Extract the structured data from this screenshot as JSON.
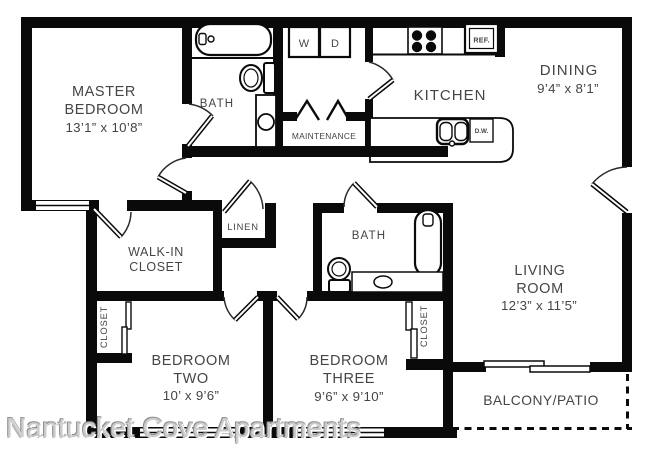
{
  "watermark": "Nantucket Cove Apartments",
  "colors": {
    "wall": "#0a0a0a",
    "label": "#454545",
    "watermark": "#cccccc",
    "background": "#ffffff"
  },
  "rooms": {
    "master_bedroom": {
      "lines": [
        "MASTER",
        "BEDROOM"
      ],
      "dims": "13’1” x 10’8”"
    },
    "master_bath": {
      "label": "BATH"
    },
    "kitchen": {
      "label": "KITCHEN"
    },
    "dining": {
      "label": "DINING",
      "dims": "9’4” x 8’1”"
    },
    "maintenance": {
      "label": "MAINTENANCE"
    },
    "walk_in_closet": {
      "lines": [
        "WALK-IN",
        "CLOSET"
      ]
    },
    "linen": {
      "label": "LINEN"
    },
    "hall_bath": {
      "label": "BATH"
    },
    "living_room": {
      "lines": [
        "LIVING",
        "ROOM"
      ],
      "dims": "12’3” x 11’5”"
    },
    "bedroom_two": {
      "lines": [
        "BEDROOM",
        "TWO"
      ],
      "dims": "10’ x 9’6”"
    },
    "bedroom_three": {
      "lines": [
        "BEDROOM",
        "THREE"
      ],
      "dims": "9’6” x 9’10”"
    },
    "bedroom_two_closet": {
      "label": "CLOSET"
    },
    "bedroom_three_closet": {
      "label": "CLOSET"
    },
    "balcony": {
      "label": "BALCONY/PATIO"
    }
  },
  "appliances": {
    "washer": "W",
    "dryer": "D",
    "refrigerator": "REF.",
    "dishwasher": "D.W."
  }
}
